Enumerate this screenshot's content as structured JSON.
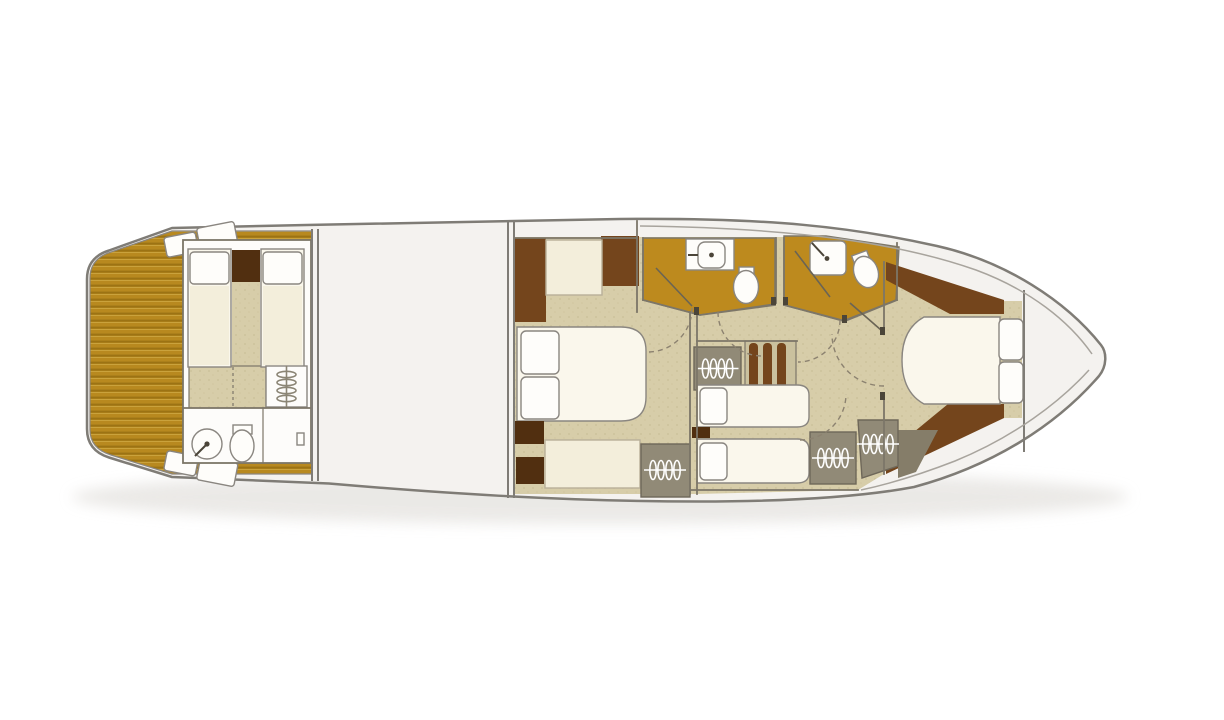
{
  "page": {
    "kind": "yacht-lower-deck-floor-plan",
    "orientation": "bow-right"
  },
  "colors": {
    "background": "#ffffff",
    "shadow": "#e6e4e1",
    "hull_fill": "#f4f2ef",
    "hull_stroke": "#7f7c76",
    "inner_line": "#a8a49d",
    "wall_stroke": "#7c7668",
    "fixture_stroke": "#8a8680",
    "teak_base": "#b8891f",
    "teak_stripe_dark": "#9c7314",
    "teak_stripe_light": "#caa23c",
    "amber_floor": "#bd8a1e",
    "beige_floor": "#d7cda9",
    "beige_dot": "#c2b68c",
    "walnut": "#74451c",
    "walnut_dark": "#512f10",
    "cream": "#f3eedb",
    "seat_stroke": "#b8b099",
    "bed_white": "#faf7ec",
    "pillow_white": "#fefdfa",
    "white_room": "#fdfcfa",
    "wardrobe_gray": "#918a77",
    "wardrobe_dark": "#857d69",
    "wardrobe_stroke": "#6e6759",
    "stair_base": "#cac19e",
    "coil_white": "#ffffff",
    "coil_gray": "#8b8575",
    "door_arc": "#8c8270",
    "door_leaf": "#6a6455",
    "hinge_dark": "#4b4539"
  },
  "areas": [
    {
      "id": "swim-platform",
      "features": [
        "teak-decking",
        "boarding-steps-port",
        "boarding-steps-starboard"
      ]
    },
    {
      "id": "crew-cabin",
      "features": [
        "single-bed",
        "single-bed",
        "nightstand",
        "stowage",
        "fan-locker",
        "washbasin",
        "toilet"
      ]
    },
    {
      "id": "engine-room",
      "features": []
    },
    {
      "id": "master-cabin",
      "features": [
        "double-bed",
        "two-pillows",
        "seat",
        "cabinet",
        "cabinet",
        "bench",
        "hanging-locker"
      ]
    },
    {
      "id": "bathroom-port",
      "features": [
        "vanity-washbasin",
        "toilet"
      ]
    },
    {
      "id": "shower-room",
      "features": [
        "shower",
        "toilet"
      ]
    },
    {
      "id": "lobby",
      "features": [
        "staircase",
        "hanging-locker",
        "door-swings"
      ]
    },
    {
      "id": "twin-cabin",
      "features": [
        "single-bed",
        "single-bed",
        "nightstand",
        "hanging-locker",
        "hanging-locker"
      ]
    },
    {
      "id": "vip-bow-cabin",
      "features": [
        "island-double-bed",
        "two-pillows",
        "walnut-trim",
        "hanging-locker"
      ]
    }
  ]
}
